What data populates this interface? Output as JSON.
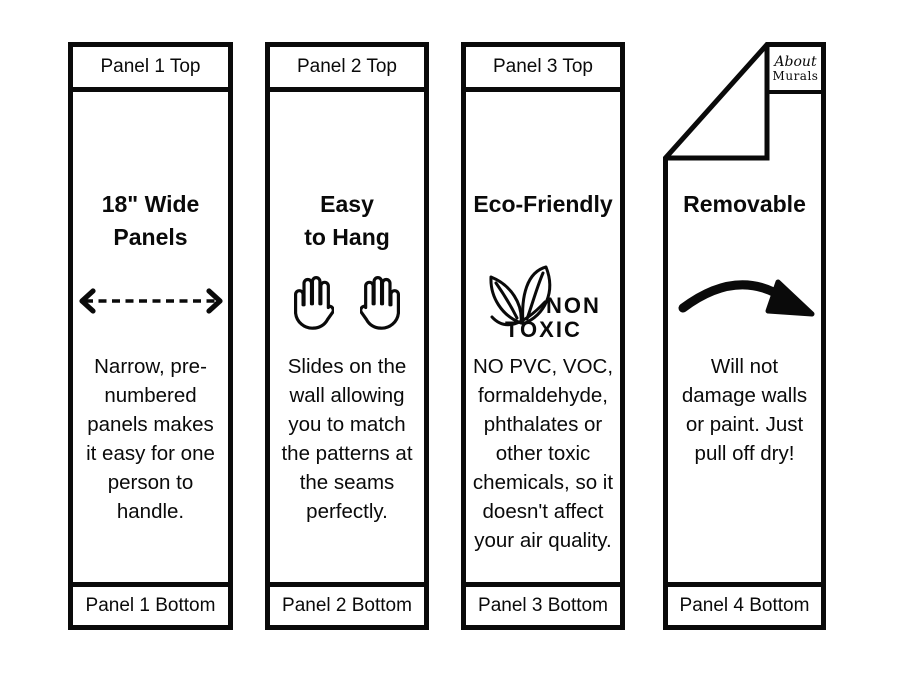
{
  "title": "Wallpaper panel features infographic",
  "colors": {
    "background": "#ffffff",
    "ink": "#0a0a0a"
  },
  "panels": [
    {
      "top_label": "Panel 1 Top",
      "title": "18\" Wide\nPanels",
      "icon": "left-right-dashed-arrow",
      "body": "Narrow, pre-\nnumbered\npanels makes\nit easy for one\nperson to\nhandle.",
      "bottom_label": "Panel 1 Bottom"
    },
    {
      "top_label": "Panel 2 Top",
      "title": "Easy\nto Hang",
      "icon": "two-open-hands",
      "body": "Slides on the\nwall allowing\nyou to match\nthe patterns at\nthe seams\nperfectly.",
      "bottom_label": "Panel 2 Bottom"
    },
    {
      "top_label": "Panel 3 Top",
      "title": "Eco-Friendly",
      "icon": "non-toxic-leaves",
      "icon_label_top": "NON",
      "icon_label_bottom": "TOXIC",
      "body": "NO PVC, VOC,\nformaldehyde,\nphthalates or\nother toxic\nchemicals, so it\ndoesn't affect\nyour air quality.",
      "bottom_label": "Panel 3 Bottom"
    },
    {
      "title": "Removable",
      "icon": "curved-peel-arrow",
      "logo_line1": "About",
      "logo_line2": "Murals",
      "body": "Will not\ndamage walls\nor paint.  Just\npull off dry!",
      "bottom_label": "Panel 4 Bottom"
    }
  ]
}
